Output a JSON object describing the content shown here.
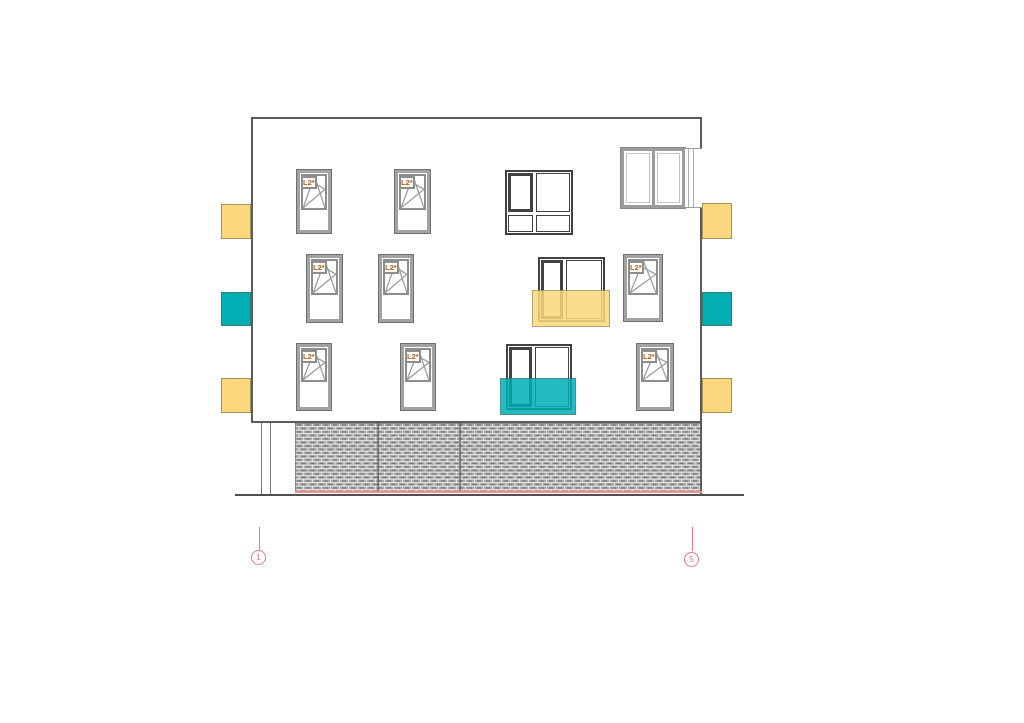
{
  "drawing": {
    "type": "architectural-elevation",
    "window_label": "L2*",
    "colors": {
      "accent_yellow": "#FBD87D",
      "accent_teal": "#00AEB4",
      "axis_pink": "#EF7490",
      "base_line_red": "#FA8C8C",
      "label_orange": "#B35E1C",
      "frame_gray": "#9A9A9A",
      "frame_dark": "#414141"
    },
    "facade": {
      "x": 251,
      "y": 117,
      "w": 451,
      "h": 306
    },
    "base_hatch": {
      "x": 295,
      "y": 423,
      "w": 407,
      "h": 70,
      "dividers_x": [
        378,
        460
      ],
      "red_line_y": 491
    },
    "ground_line": {
      "x1": 235,
      "x2": 744,
      "y": 494
    },
    "downpipe": {
      "x1": 261,
      "x2": 270,
      "y1": 423,
      "y2": 494
    },
    "tilt_turn_windows": [
      {
        "x": 297,
        "y": 170,
        "w": 34,
        "h": 63,
        "sash": 45
      },
      {
        "x": 395,
        "y": 170,
        "w": 35,
        "h": 63,
        "sash": 45
      },
      {
        "x": 307,
        "y": 255,
        "w": 35,
        "h": 67,
        "sash": 45
      },
      {
        "x": 379,
        "y": 255,
        "w": 34,
        "h": 67,
        "sash": 45
      },
      {
        "x": 624,
        "y": 255,
        "w": 38,
        "h": 66,
        "sash": 45
      },
      {
        "x": 297,
        "y": 344,
        "w": 34,
        "h": 66,
        "sash": 43
      },
      {
        "x": 401,
        "y": 344,
        "w": 34,
        "h": 66,
        "sash": 43
      },
      {
        "x": 637,
        "y": 344,
        "w": 36,
        "h": 66,
        "sash": 43
      }
    ],
    "dark_windows": [
      {
        "kind": "quad",
        "x": 505,
        "y": 170,
        "w": 68,
        "h": 65,
        "sash_w": 28,
        "sash_h": 42
      },
      {
        "kind": "pair",
        "x": 538,
        "y": 257,
        "w": 67,
        "h": 65,
        "sash_w": 25
      },
      {
        "kind": "pair",
        "x": 506,
        "y": 344,
        "w": 66,
        "h": 66,
        "sash_w": 26
      }
    ],
    "corner_window": {
      "x": 621,
      "y": 148,
      "w": 64,
      "h": 60,
      "strip_w": 17
    },
    "side_panels": [
      {
        "x": 221,
        "y": 204,
        "w": 30,
        "h": 35,
        "color": "yellow"
      },
      {
        "x": 221,
        "y": 292,
        "w": 30,
        "h": 34,
        "color": "teal"
      },
      {
        "x": 221,
        "y": 378,
        "w": 30,
        "h": 35,
        "color": "yellow"
      },
      {
        "x": 702,
        "y": 203,
        "w": 30,
        "h": 36,
        "color": "yellow"
      },
      {
        "x": 702,
        "y": 292,
        "w": 30,
        "h": 34,
        "color": "teal"
      },
      {
        "x": 702,
        "y": 378,
        "w": 30,
        "h": 35,
        "color": "yellow"
      }
    ],
    "balcony_overlays": [
      {
        "x": 532,
        "y": 290,
        "w": 78,
        "h": 37,
        "color": "yellow"
      },
      {
        "x": 500,
        "y": 378,
        "w": 76,
        "h": 37,
        "color": "teal"
      }
    ],
    "axis_markers": [
      {
        "label": "1",
        "x": 259,
        "line_y1": 527,
        "line_y2": 550,
        "bubble_cy": 558
      },
      {
        "label": "5",
        "x": 692,
        "line_y1": 527,
        "line_y2": 551,
        "bubble_cy": 560
      }
    ]
  }
}
